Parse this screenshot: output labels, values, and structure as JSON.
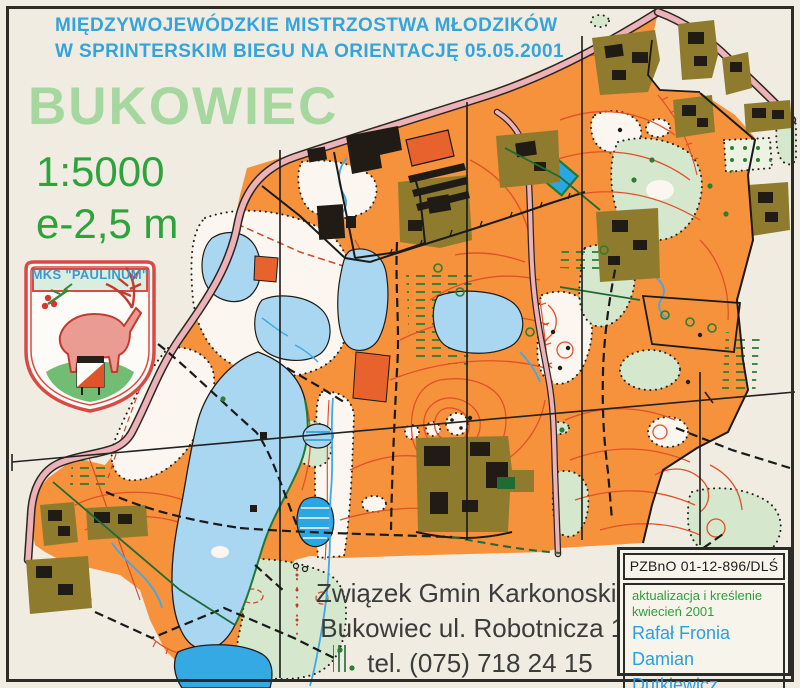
{
  "header": {
    "line1": "MIĘDZYWOJEWÓDZKIE MISTRZOSTWA MŁODZIKÓW",
    "line2": "W SPRINTERSKIM BIEGU NA ORIENTACJĘ  05.05.2001"
  },
  "title": "BUKOWIEC",
  "scale": "1:5000",
  "contour_interval": "e-2,5 m",
  "logo": {
    "club": "MKS \"PAULINUM\""
  },
  "address": {
    "line1": "Związek Gmin Karkonoskich",
    "line2": "Bukowiec ul. Robotnicza 15",
    "line3": "tel. (075) 718 24 15"
  },
  "credits": {
    "registry": "PZBnO 01-12-896/DLŚ",
    "update_note1": "aktualizacja i kreślenie",
    "update_note2": "kwiecień 2001",
    "author1": "Rafał Fronia",
    "author2": "Damian Dutkiewicz"
  },
  "colors": {
    "header_blue": "#35A3DC",
    "title_green": "#A6D79F",
    "scale_green": "#2FA33B",
    "note_green": "#2E9E3C",
    "author_blue": "#2AA0DE",
    "map_orange": "#F5923B",
    "road_pink": "#ECB2B8",
    "lake_blue": "#A9D7F1",
    "pond_bright_blue": "#2AA7E3",
    "contour_red": "#E0512A",
    "settlement_olive": "#8F7B2E",
    "vegetation_green": "#D5E7CD",
    "paper": "#F0ECE2"
  }
}
